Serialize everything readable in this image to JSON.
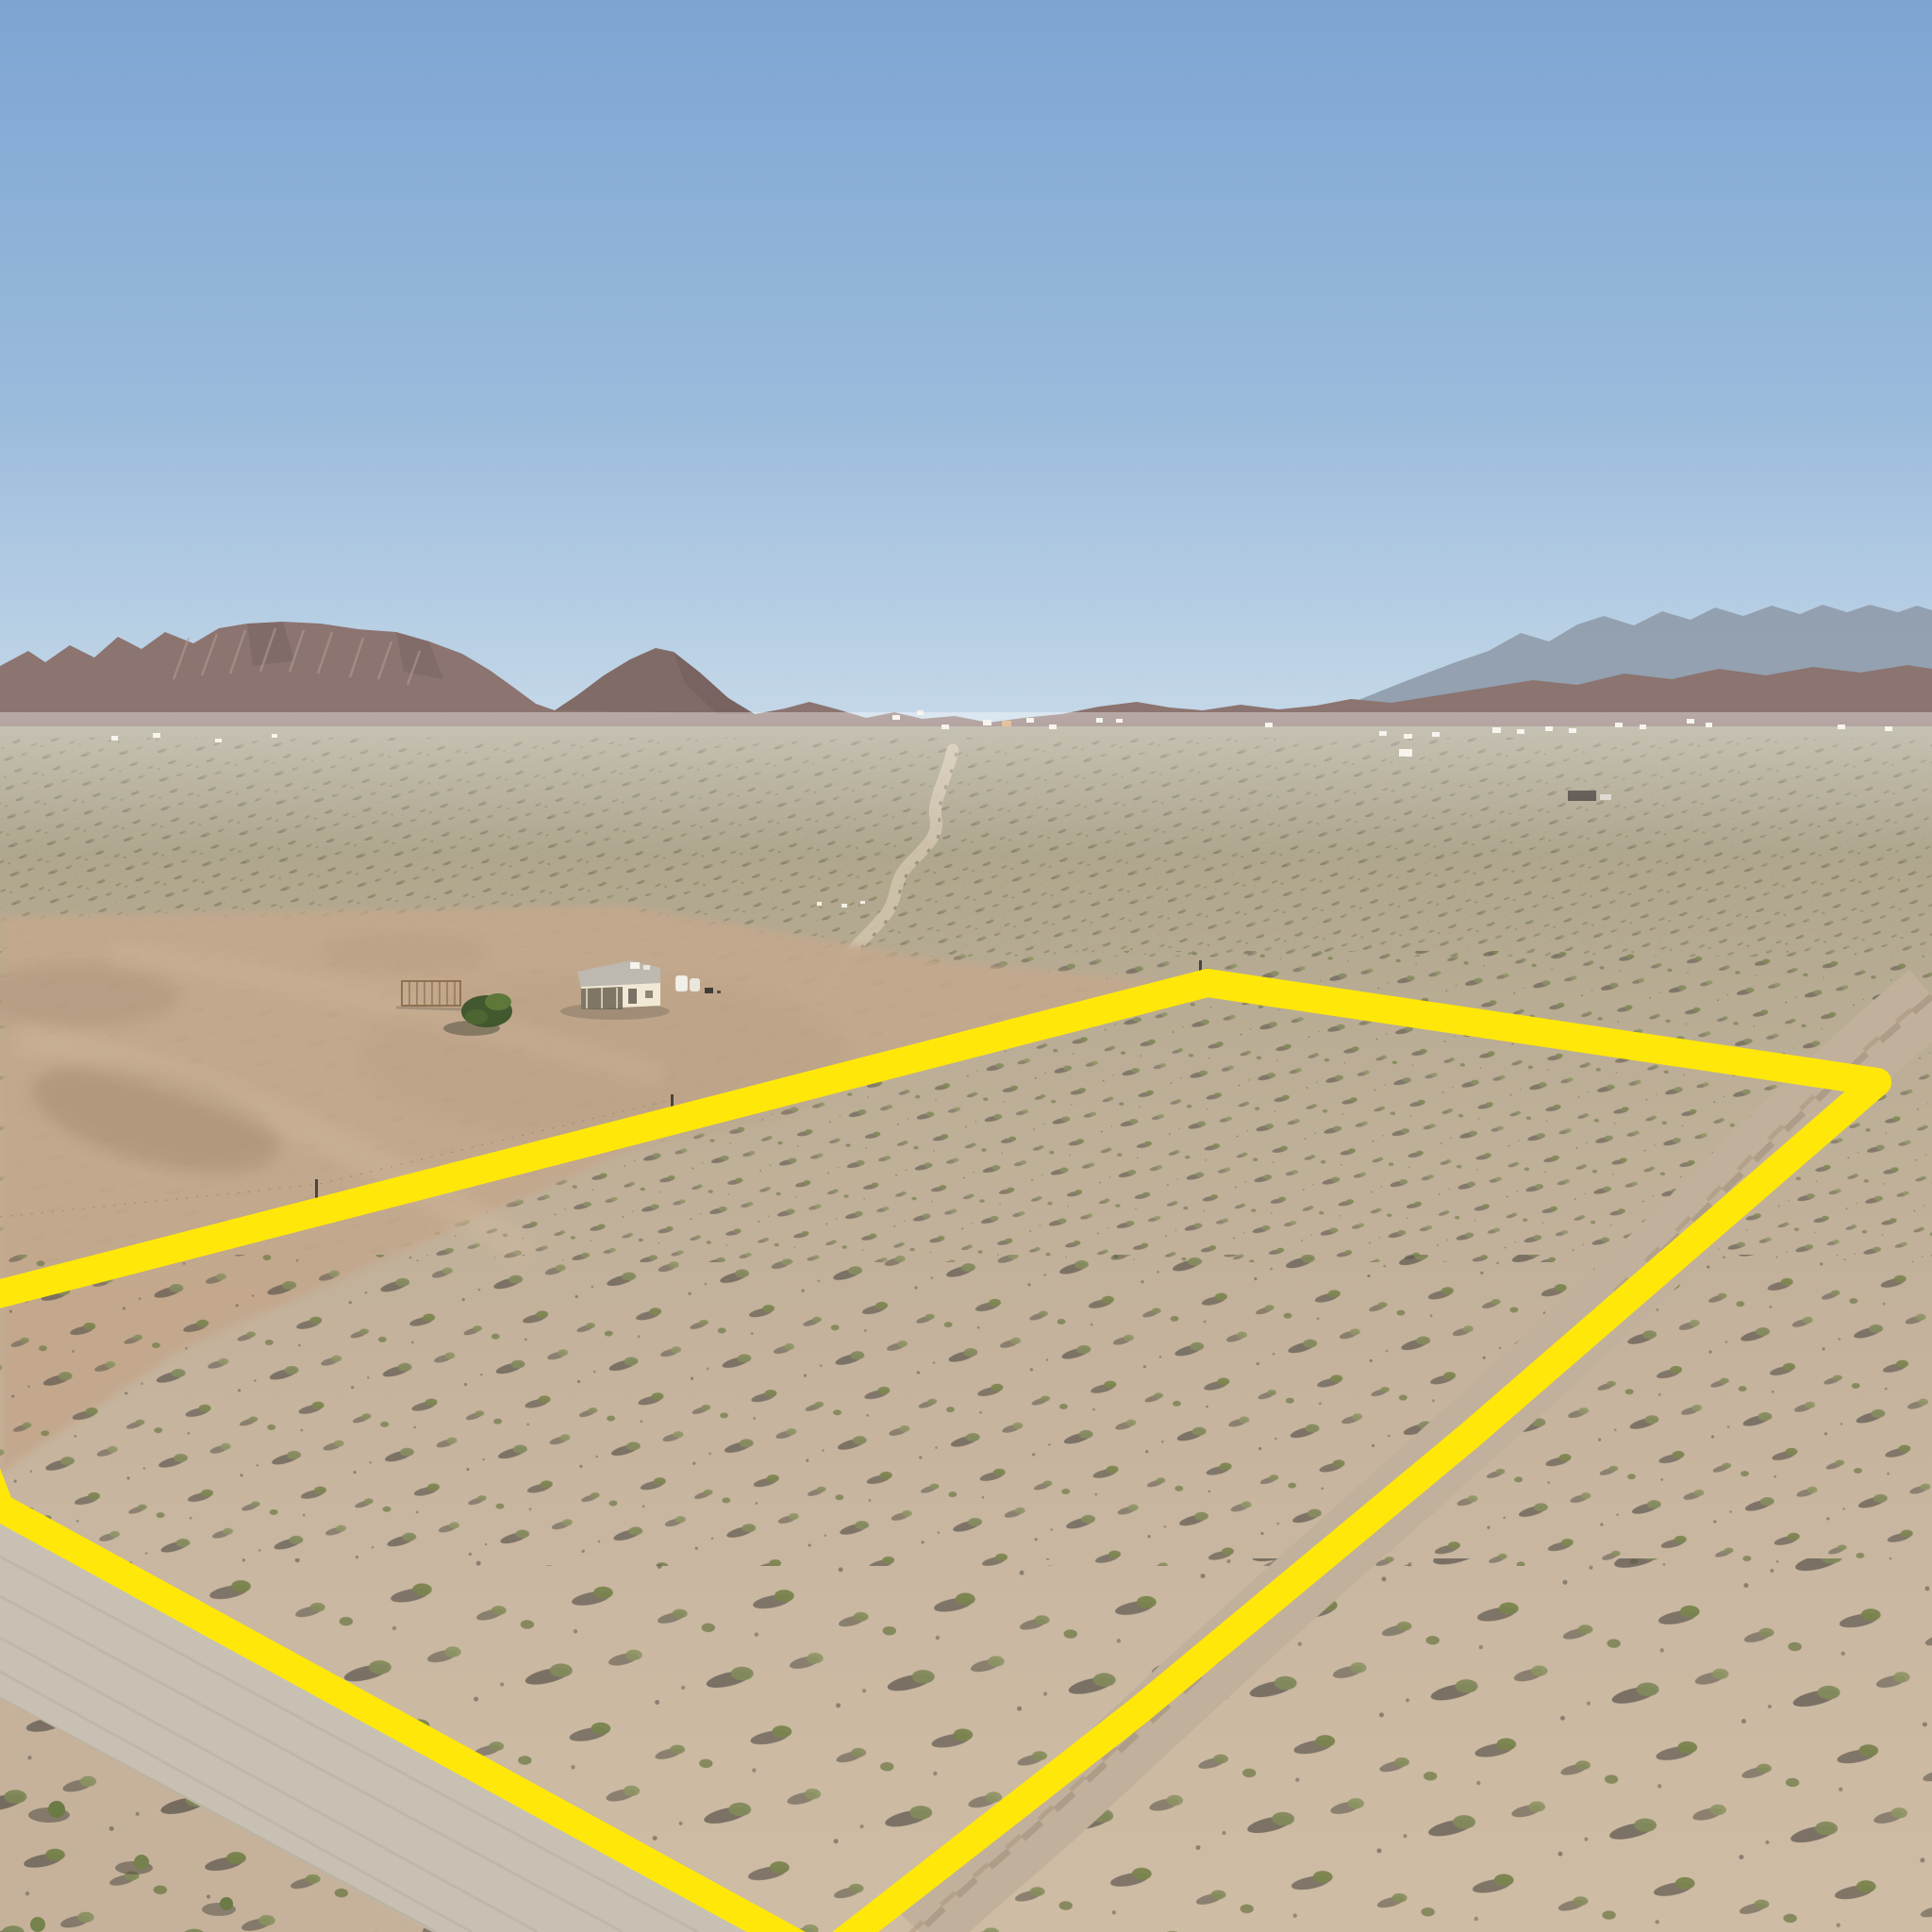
{
  "scene": {
    "type": "aerial-drone-photo",
    "description": "Aerial view of flat desert acreage with a vacant land parcel outlined in thick yellow, desert mountain ranges on the horizon under a clear blue sky",
    "features": {
      "boundary": "yellow property-line outline around vacant parcel",
      "homestead": "small cream house with gray roof, wooden frame structure, green tree and white tanks on cleared dirt pad left of parcel",
      "gravel_road": "graded gravel road crossing the lower-left foreground",
      "dirt_trail": "two-track dirt trail running along the right boundary line",
      "wash": "winding sandy wash in the mid-distance",
      "far_houses": "scattered rural homes at the base of the mountains",
      "mountains": "brown rocky mesa and ridges left, hazy tall range right"
    }
  },
  "colors": {
    "sky_top": "#7da5d2",
    "sky_mid": "#9bbbdc",
    "sky_horizon": "#c9dbe9",
    "range_far": "#8f9cab",
    "mountain": "#8c7470",
    "mountain_dark": "#6e5b58",
    "mountain_light": "#b2a095",
    "plain_far": "#a8a18b",
    "ground_fore": "#cfbca4",
    "pad": "#c3a88d",
    "road": "#c8c1b3",
    "trail": "#c1b09b",
    "boundary": "#ffe70a",
    "house_wall": "#f1e9d5",
    "house_roof": "#bdb8b0",
    "tree_dark": "#42582f",
    "shrub_green": "#7e8757",
    "shrub_shadow": "#59534a",
    "white_speck": "#f2efe4"
  }
}
